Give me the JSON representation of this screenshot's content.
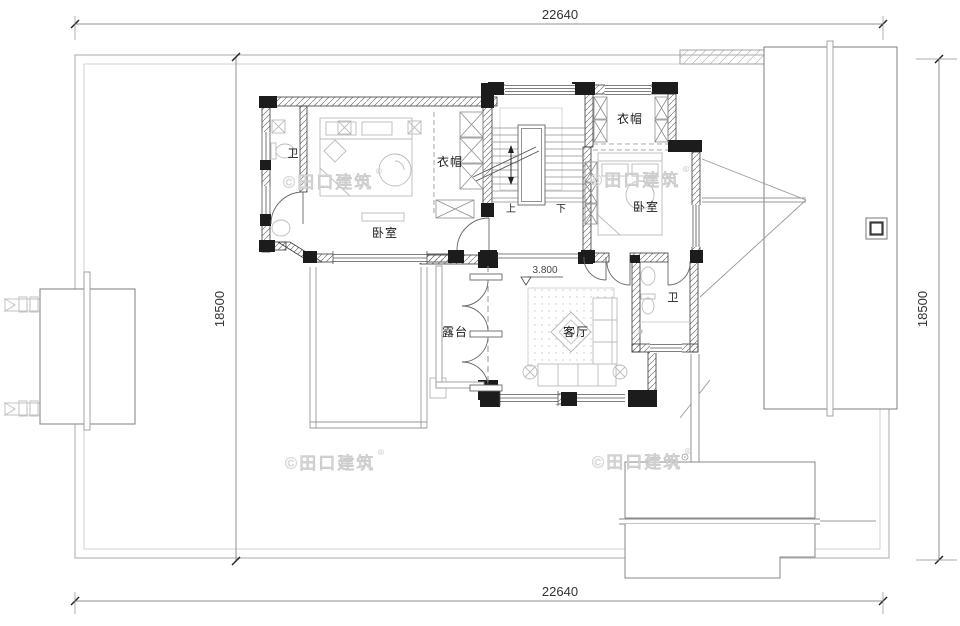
{
  "drawing": {
    "type": "architectural-floor-plan",
    "floor_level": "3.800"
  },
  "dimensions": {
    "top": "22640",
    "bottom": "22640",
    "left": "18500",
    "right": "18500"
  },
  "rooms": {
    "bath_left": "卫",
    "bedroom_left": "卧室",
    "closet_left": "衣帽",
    "closet_right": "衣帽",
    "bedroom_right": "卧室",
    "bath_right": "卫",
    "living_room": "客厅",
    "terrace": "露台"
  },
  "stairs": {
    "up": "上",
    "down": "下"
  },
  "level_marker": "3.800",
  "watermark": {
    "text": "©田口建筑",
    "reg": "®"
  },
  "colors": {
    "wall_fill": "#1c1c1c",
    "line_gray": "#8a8a8a",
    "furniture_gray": "#bcbcbc",
    "dim_text": "#333333",
    "watermark_gray": "#dedede",
    "background": "#ffffff"
  }
}
